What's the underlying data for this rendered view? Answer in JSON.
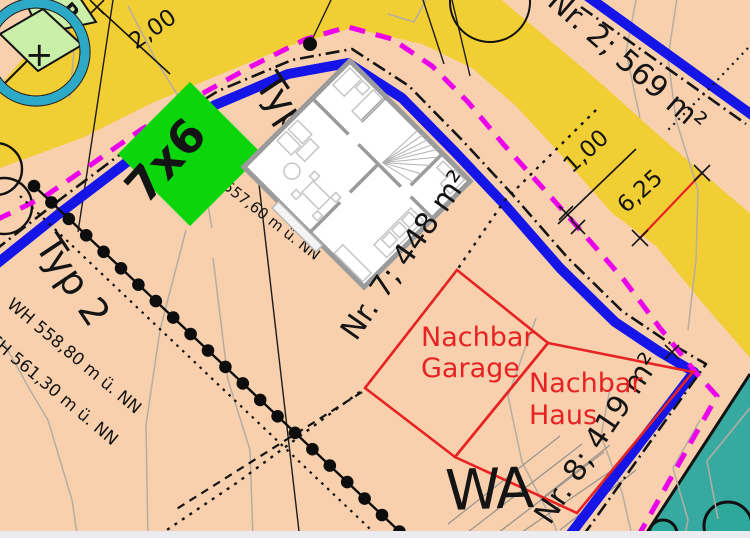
{
  "map": {
    "labels": {
      "plot2": "Nr. 2; 569 m²",
      "plot7": "Nr. 7; 448 m²",
      "plot8": "Nr. 8; 419 m²",
      "zone": "WA",
      "typ_partial": "Typ",
      "typ2": "Typ 2",
      "typ2_wh": "WH 558,80 m ü. NN",
      "typ2_fh": "FH 561,30 m ü. NN",
      "house_elevation": "557,60 m ü. NN",
      "garage_line1": "Nachbar",
      "garage_line2": "Garage",
      "haus_line1": "Nachbar",
      "haus_line2": "Haus",
      "size_marker": "7x6",
      "plus_symbol": "+",
      "parking_letter": "P"
    },
    "dimensions": {
      "d200": "2,00",
      "d100": "1,00",
      "d625": "6,25"
    },
    "colors": {
      "ground_pink": "#f8d0ae",
      "zone_yellow": "#f2ce35",
      "road_blue": "#1515e8",
      "boundary_magenta": "#ea00ea",
      "neighbor_red": "#e62222",
      "marker_green": "#0bd60b",
      "area_teal": "#36aaa0",
      "ring_teal": "#2ba9c6",
      "light_green": "#c9efa9"
    }
  }
}
